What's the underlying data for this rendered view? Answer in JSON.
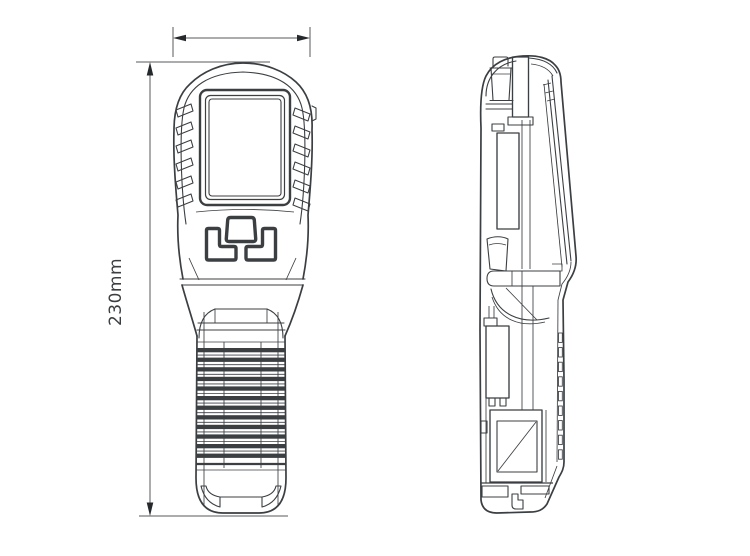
{
  "colors": {
    "background": "#ffffff",
    "line": "#3b3f42",
    "dimension_line": "#55585c",
    "arrow": "#26292c",
    "text": "#3b3f42"
  },
  "dimensions": {
    "height_label": "230mm"
  }
}
